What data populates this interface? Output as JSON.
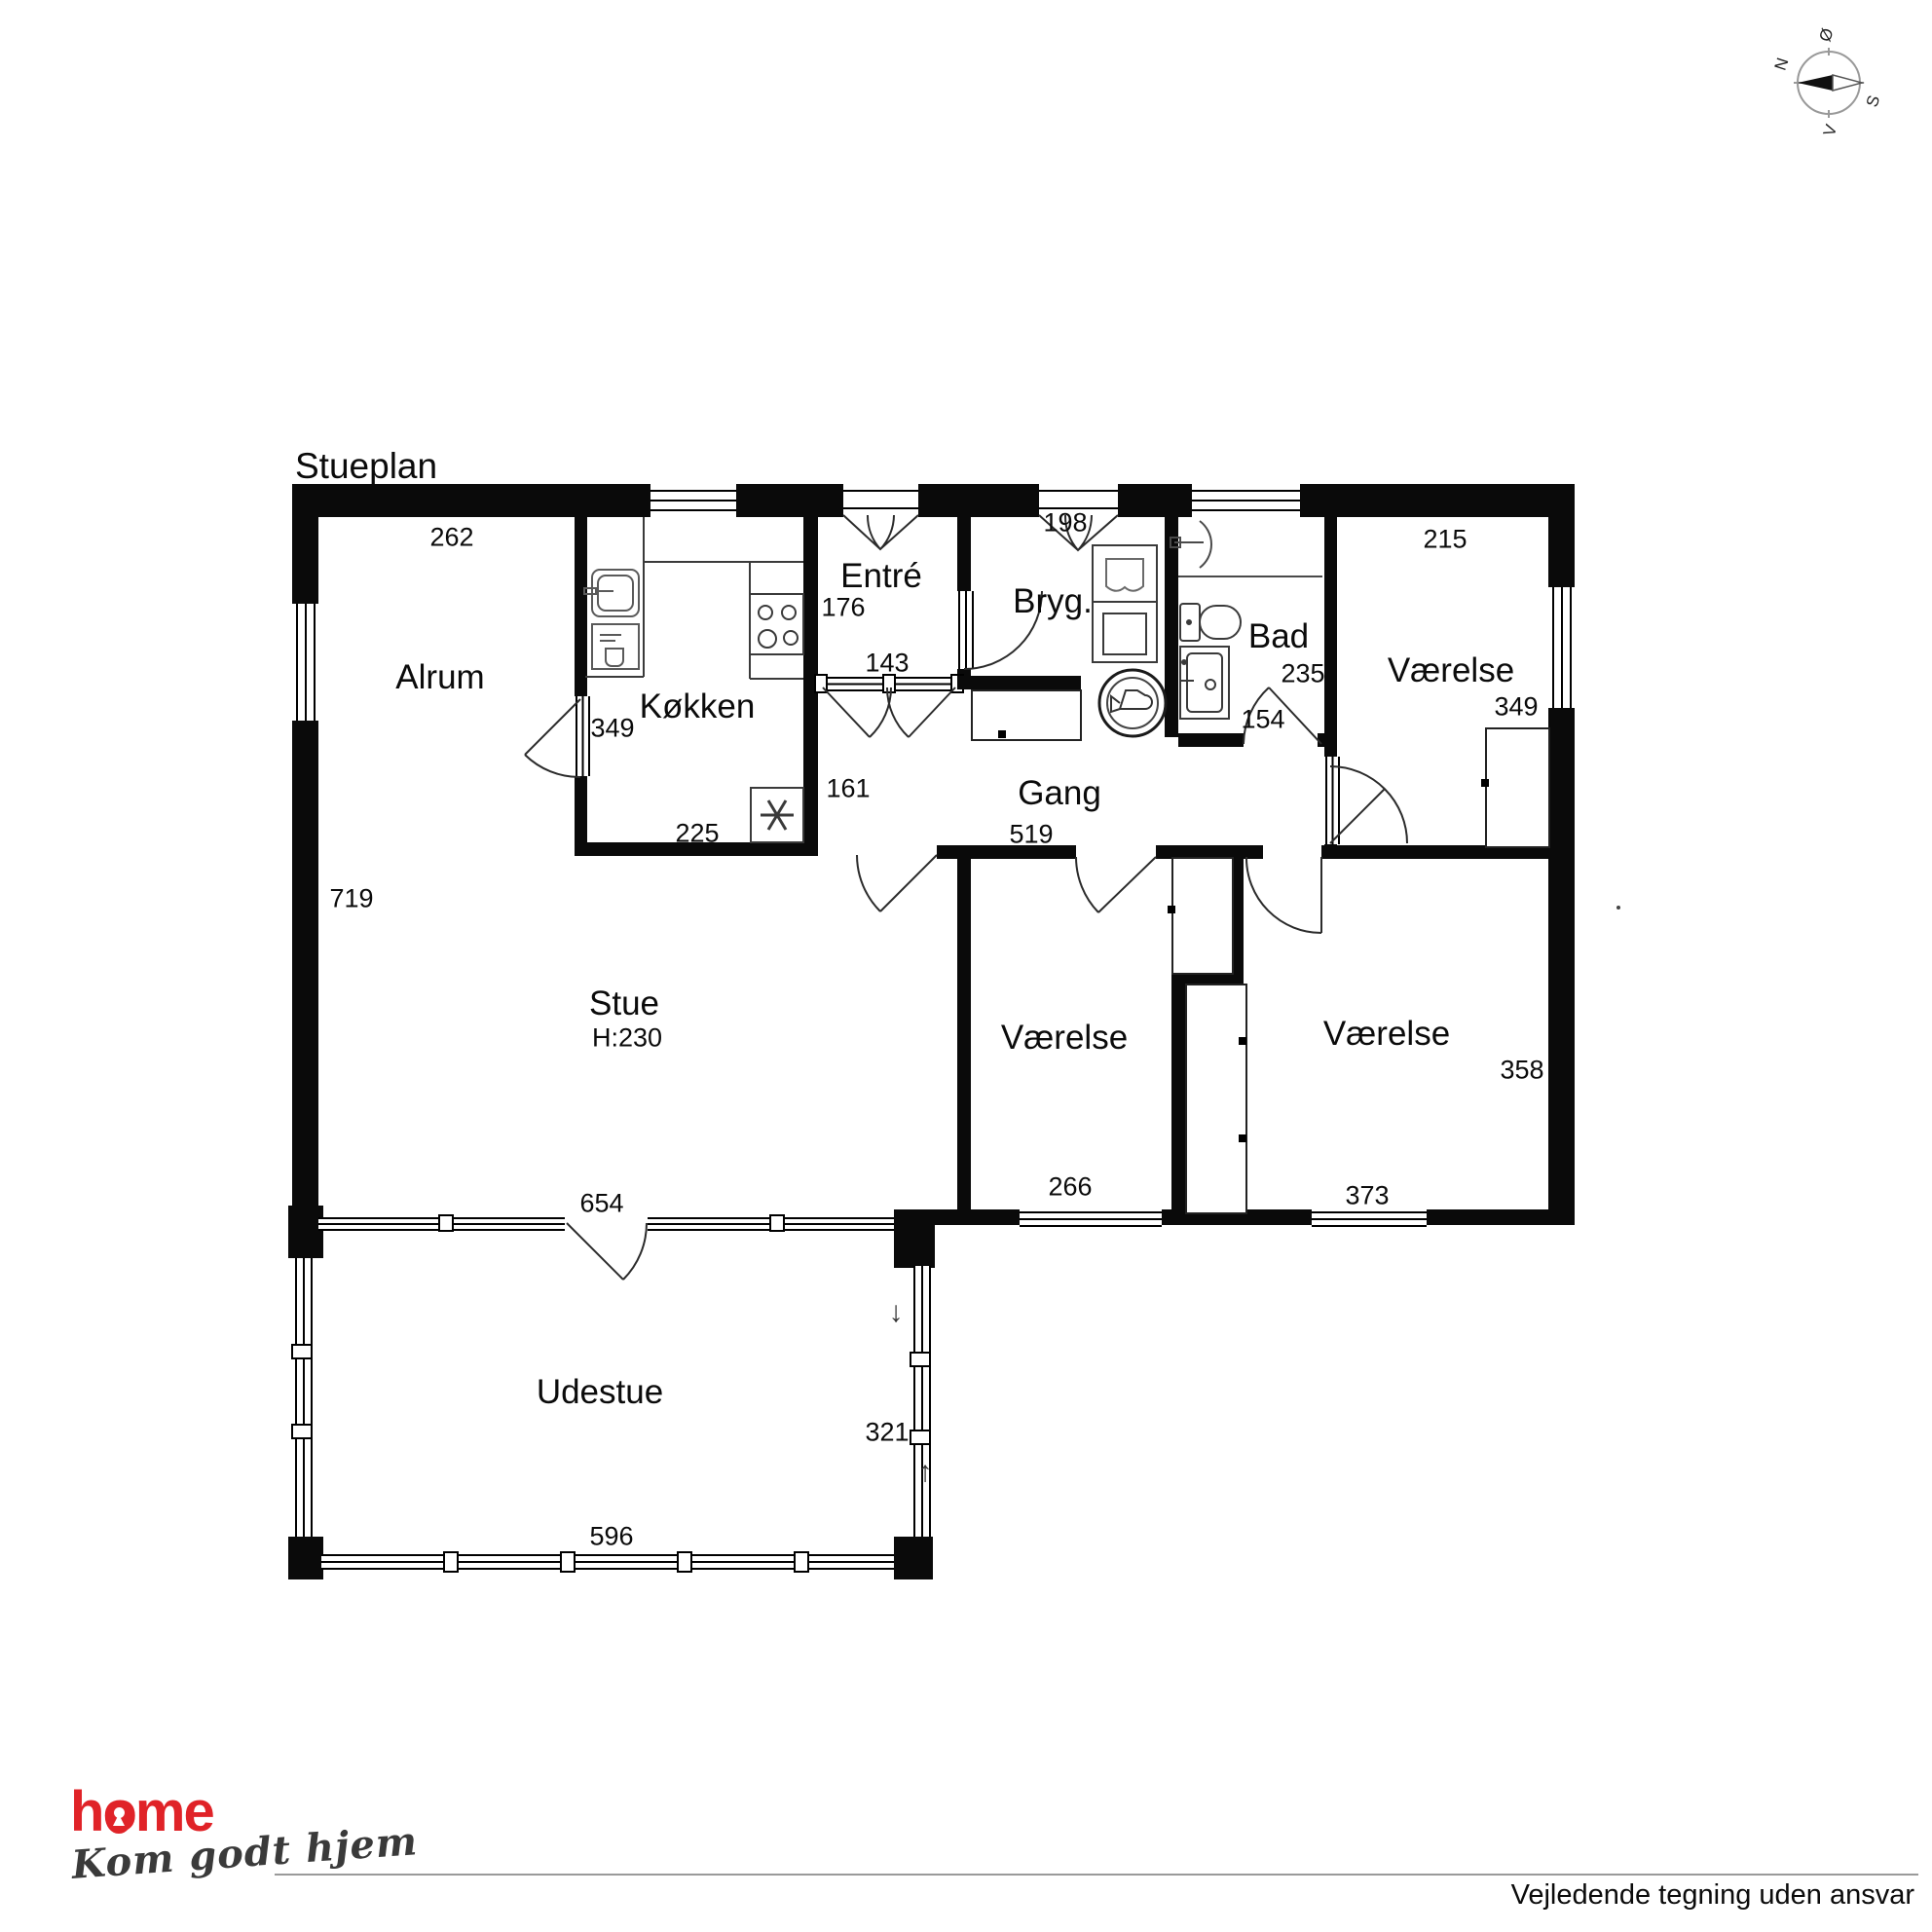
{
  "title": "Stueplan",
  "compass": {
    "north": "N",
    "south": "S",
    "east": "Ø",
    "west": "V"
  },
  "rooms": {
    "alrum": "Alrum",
    "kokken": "Køkken",
    "entre": "Entré",
    "bryg": "Bryg.",
    "bad": "Bad",
    "gang": "Gang",
    "stue": "Stue",
    "stue_height": "H:230",
    "vaerelse_ne": "Værelse",
    "vaerelse_mid": "Værelse",
    "vaerelse_se": "Værelse",
    "udestue": "Udestue"
  },
  "dims": {
    "alrum_top": "262",
    "alrum_left": "719",
    "kokken_door": "349",
    "kokken_bottom": "225",
    "kokken_right": "161",
    "entre_depth": "176",
    "entre_width": "143",
    "bryg_door": "198",
    "gang_width": "519",
    "bad_width": "235",
    "bad_door": "154",
    "vaerelse_ne_top": "215",
    "vaerelse_ne_right": "349",
    "vaerelse_se_right": "358",
    "vaerelse_mid_bottom": "266",
    "vaerelse_se_bottom": "373",
    "stue_bottom": "654",
    "udestue_right": "321",
    "udestue_bottom": "596"
  },
  "arrows": {
    "down": "↓",
    "up": "↑"
  },
  "logo": {
    "brand_h": "h",
    "brand_o": "o",
    "brand_me": "me",
    "tagline": "Kom godt hjem"
  },
  "footer": {
    "disclaimer": "Vejledende tegning uden ansvar"
  }
}
